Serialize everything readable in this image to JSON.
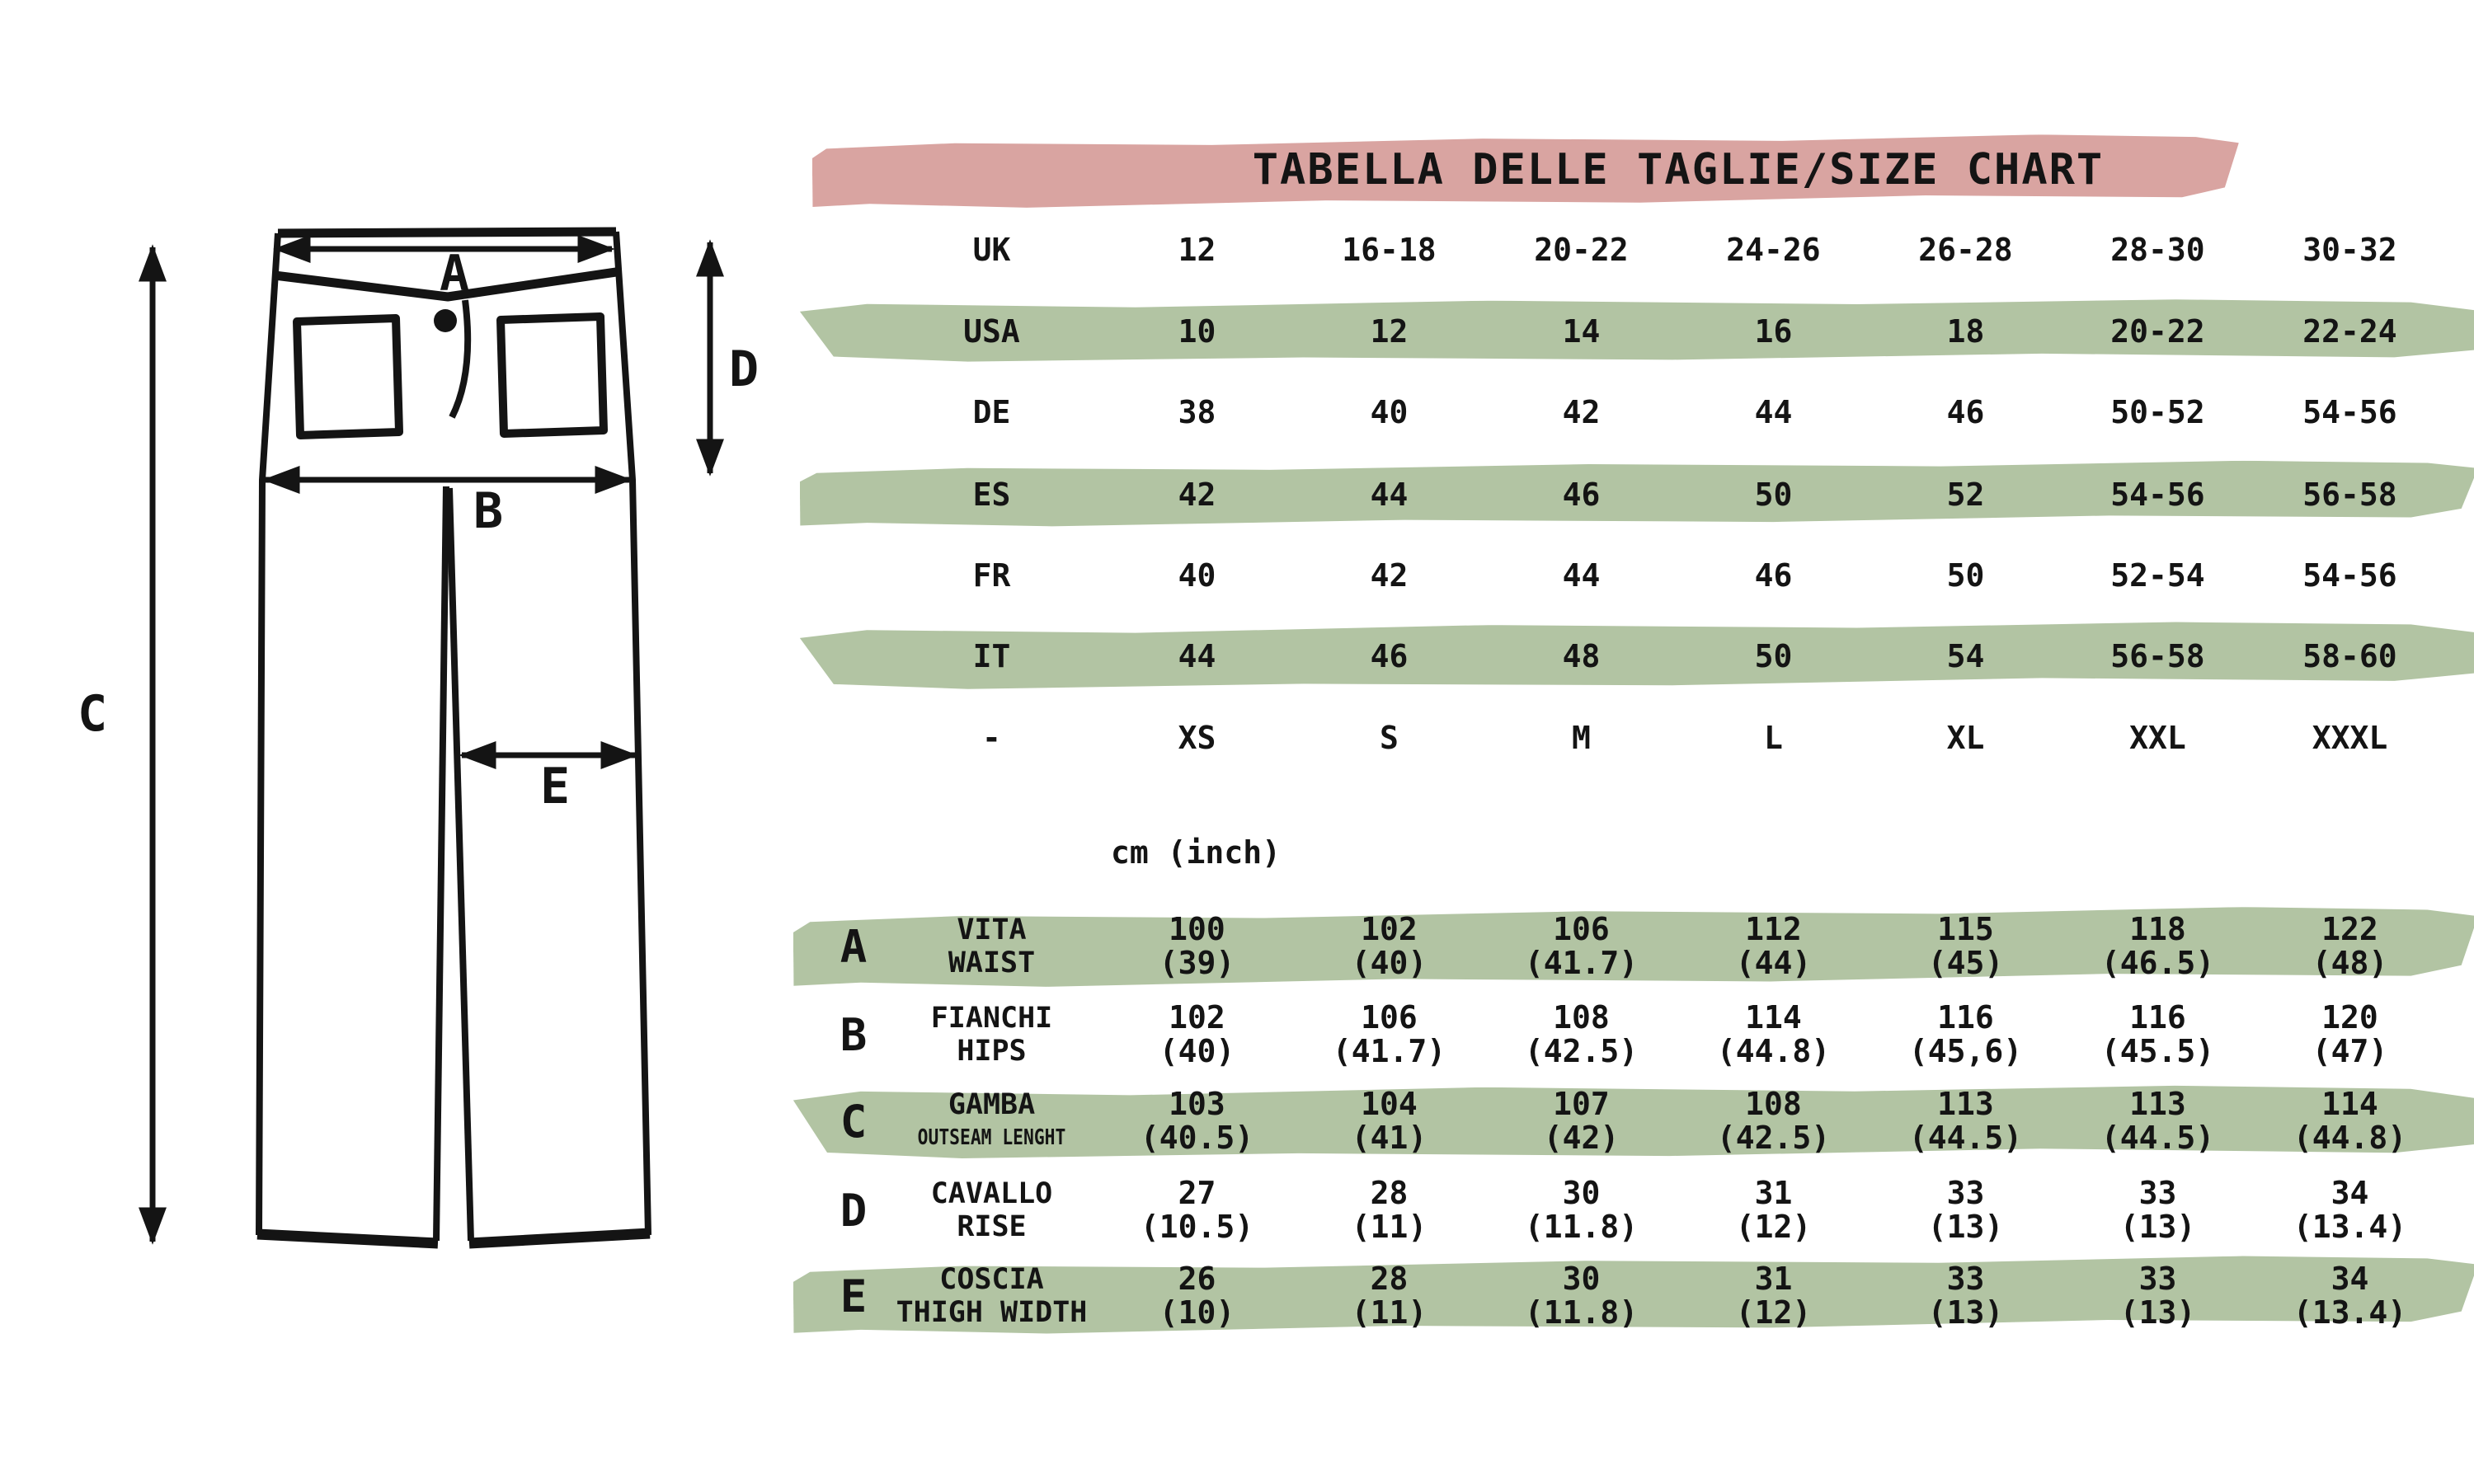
{
  "title": "TABELLA DELLE TAGLIE/SIZE CHART",
  "unit_label": "cm (inch)",
  "colors": {
    "banner_pink": "#d9a4a1",
    "row_green": "#b2c4a3",
    "ink": "#141414"
  },
  "diagram": {
    "letters": [
      "A",
      "B",
      "C",
      "D",
      "E"
    ]
  },
  "size_conversion": [
    {
      "region": "UK",
      "values": [
        "12",
        "16-18",
        "20-22",
        "24-26",
        "26-28",
        "28-30",
        "30-32"
      ]
    },
    {
      "region": "USA",
      "values": [
        "10",
        "12",
        "14",
        "16",
        "18",
        "20-22",
        "22-24"
      ]
    },
    {
      "region": "DE",
      "values": [
        "38",
        "40",
        "42",
        "44",
        "46",
        "50-52",
        "54-56"
      ]
    },
    {
      "region": "ES",
      "values": [
        "42",
        "44",
        "46",
        "50",
        "52",
        "54-56",
        "56-58"
      ]
    },
    {
      "region": "FR",
      "values": [
        "40",
        "42",
        "44",
        "46",
        "50",
        "52-54",
        "54-56"
      ]
    },
    {
      "region": "IT",
      "values": [
        "44",
        "46",
        "48",
        "50",
        "54",
        "56-58",
        "58-60"
      ]
    },
    {
      "region": "-",
      "values": [
        "XS",
        "S",
        "M",
        "L",
        "XL",
        "XXL",
        "XXXL"
      ]
    }
  ],
  "measurements": [
    {
      "letter": "A",
      "label_it": "VITA",
      "label_en": "WAIST",
      "cm": [
        "100",
        "102",
        "106",
        "112",
        "115",
        "118",
        "122"
      ],
      "inch": [
        "(39)",
        "(40)",
        "(41.7)",
        "(44)",
        "(45)",
        "(46.5)",
        "(48)"
      ]
    },
    {
      "letter": "B",
      "label_it": "FIANCHI",
      "label_en": "HIPS",
      "cm": [
        "102",
        "106",
        "108",
        "114",
        "116",
        "116",
        "120"
      ],
      "inch": [
        "(40)",
        "(41.7)",
        "(42.5)",
        "(44.8)",
        "(45,6)",
        "(45.5)",
        "(47)"
      ]
    },
    {
      "letter": "C",
      "label_it": "GAMBA",
      "label_en": "OUTSEAM LENGHT",
      "cm": [
        "103",
        "104",
        "107",
        "108",
        "113",
        "113",
        "114"
      ],
      "inch": [
        "(40.5)",
        "(41)",
        "(42)",
        "(42.5)",
        "(44.5)",
        "(44.5)",
        "(44.8)"
      ]
    },
    {
      "letter": "D",
      "label_it": "CAVALLO",
      "label_en": "RISE",
      "cm": [
        "27",
        "28",
        "30",
        "31",
        "33",
        "33",
        "34"
      ],
      "inch": [
        "(10.5)",
        "(11)",
        "(11.8)",
        "(12)",
        "(13)",
        "(13)",
        "(13.4)"
      ]
    },
    {
      "letter": "E",
      "label_it": "COSCIA",
      "label_en": "THIGH WIDTH",
      "cm": [
        "26",
        "28",
        "30",
        "31",
        "33",
        "33",
        "34"
      ],
      "inch": [
        "(10)",
        "(11)",
        "(11.8)",
        "(12)",
        "(13)",
        "(13)",
        "(13.4)"
      ]
    }
  ]
}
